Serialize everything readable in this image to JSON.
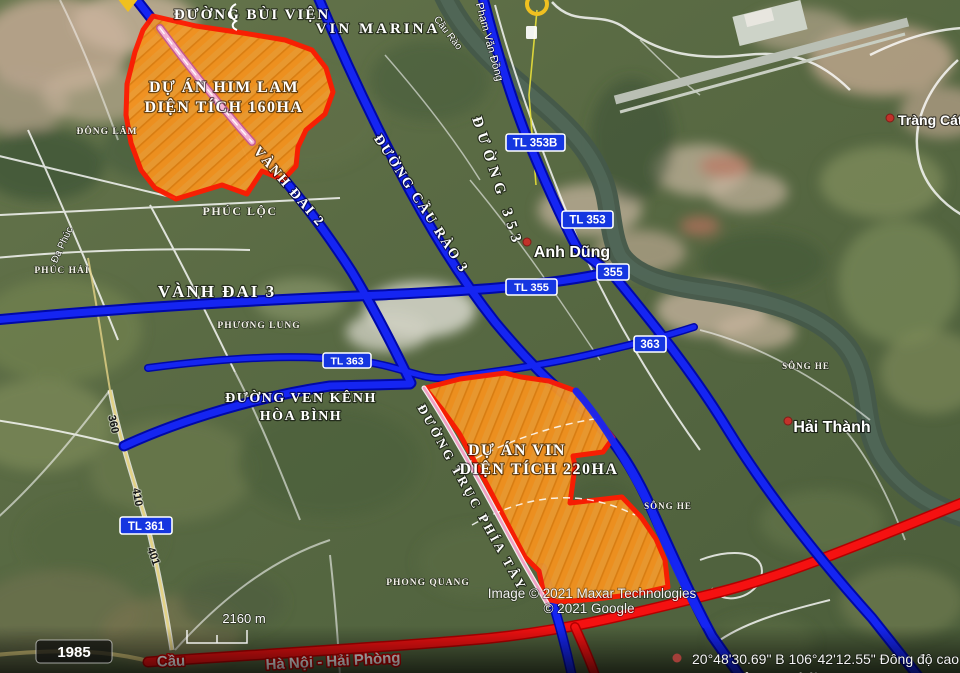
{
  "colors": {
    "road_blue": "#1525f2",
    "road_blue_casing": "#0008a8",
    "road_red": "#f51111",
    "project_fill": "#f5921e",
    "project_border": "#ff1b00",
    "construction_pink": "#f4b4d4",
    "badge_blue": "#1536e0",
    "marker_yellow": "#f0c020",
    "river_green": "#44584a"
  },
  "projects": {
    "him_lam": {
      "line1": "DỰ ÁN HIM LAM",
      "line2": "DIỆN TÍCH 160HA"
    },
    "vin": {
      "line1": "DỰ ÁN VIN",
      "line2": "DIỆN TÍCH 220HA"
    }
  },
  "road_labels": {
    "bui_vien": "ĐƯỜNG BÙI VIỆN",
    "vanh_dai_2": "VÀNH ĐAI 2",
    "vanh_dai_3": "VÀNH ĐAI 3",
    "cau_rao_3": "ĐƯỜNG CẦU RÀO 3",
    "duong_353": "ĐƯỜNG 353",
    "ven_kenh_1": "ĐƯỜNG VEN KÊNH",
    "ven_kenh_2": "HÒA BÌNH",
    "truc_phia_tay": "ĐƯỜNG TRỤC PHÍA TÂY",
    "pham_van_dong": "Phạm Văn Đồng",
    "cau_rao": "Cầu Rào",
    "cau": "Cầu",
    "ha_noi_hai_phong": "Hà Nội - Hải Phòng"
  },
  "place_labels": {
    "vin_marina": "VIN MARINA",
    "dong_lam": "ĐÔNG LÂM",
    "phuc_loc": "PHÚC LỘC",
    "phuc_hai": "PHÚC HẢI",
    "da_phuc": "Đa Phúc",
    "phuong_lung": "PHƯƠNG LUNG",
    "anh_dung": "Anh Dũng",
    "hai_thanh": "Hải Thành",
    "trang_cat": "Tràng Cát",
    "song_he_1": "SÔNG HE",
    "song_he_2": "SÔNG HE",
    "phong_quang": "PHONG QUANG",
    "hoa_nghia": "Hòa Nghĩa"
  },
  "route_badges": {
    "tl353b": "TL 353B",
    "tl353": "TL 353",
    "b355": "355",
    "tl355": "TL 355",
    "tl363": "TL 363",
    "b363": "363",
    "tl361": "TL 361"
  },
  "road_numbers": {
    "n360": "360",
    "n410": "410",
    "n401": "401"
  },
  "scale": {
    "distance": "2160 m",
    "year_badge": "1985"
  },
  "attribution": {
    "line1": "Image © 2021 Maxar Technologies",
    "line2": "© 2021 Google"
  },
  "status": {
    "coordinates": "20°48'30.69\" B   106°42'12.55\" Đông   độ cao"
  }
}
